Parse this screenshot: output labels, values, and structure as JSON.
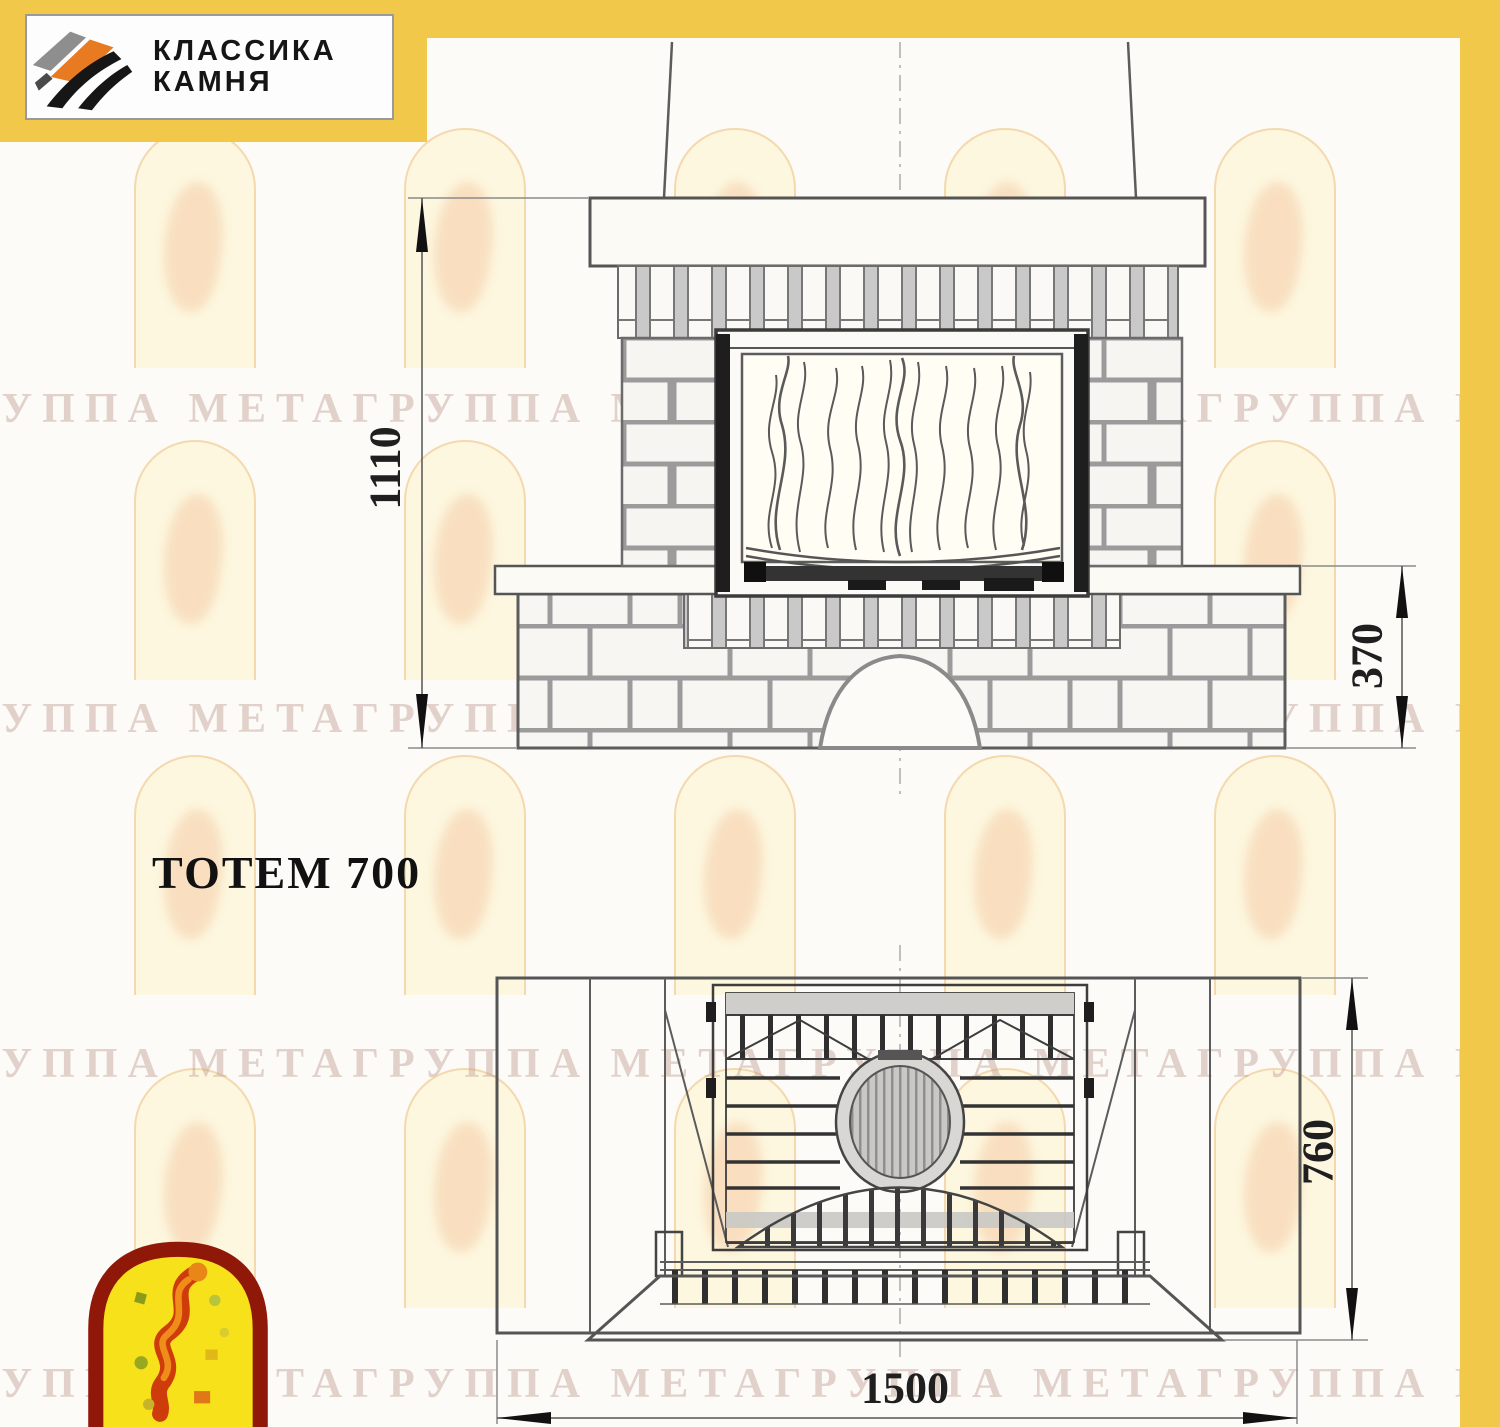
{
  "page": {
    "background": "#fcfbf7",
    "accent_yellow": "#f2c84b",
    "line_gray": "#5c5c5c",
    "watermark_color": "rgba(186,148,136,0.40)"
  },
  "logo": {
    "line1": "КЛАССИКА",
    "line2": "КАМНЯ",
    "mark_colors": {
      "gray": "#8e8e8e",
      "orange": "#e87a22",
      "black": "#161616"
    }
  },
  "title": {
    "model_label": "ТОТЕМ 700"
  },
  "drawing": {
    "front_view": {
      "label": "front-elevation-of-fireplace",
      "dim_total_height": "1110",
      "dim_bench_height": "370"
    },
    "plan_view": {
      "label": "top-plan-of-fireplace",
      "dim_depth": "760",
      "dim_width": "1500"
    }
  },
  "watermark": {
    "text": "ГРУППА МЕТАГРУППА МЕТАГРУППА МЕТАГРУППА МЕТА"
  },
  "mascot": {
    "colors": {
      "border_red": "#8f1808",
      "fill_yellow": "#f6e11a",
      "figure_red": "#cf3c0c",
      "figure_orange": "#ef8c1a"
    }
  }
}
